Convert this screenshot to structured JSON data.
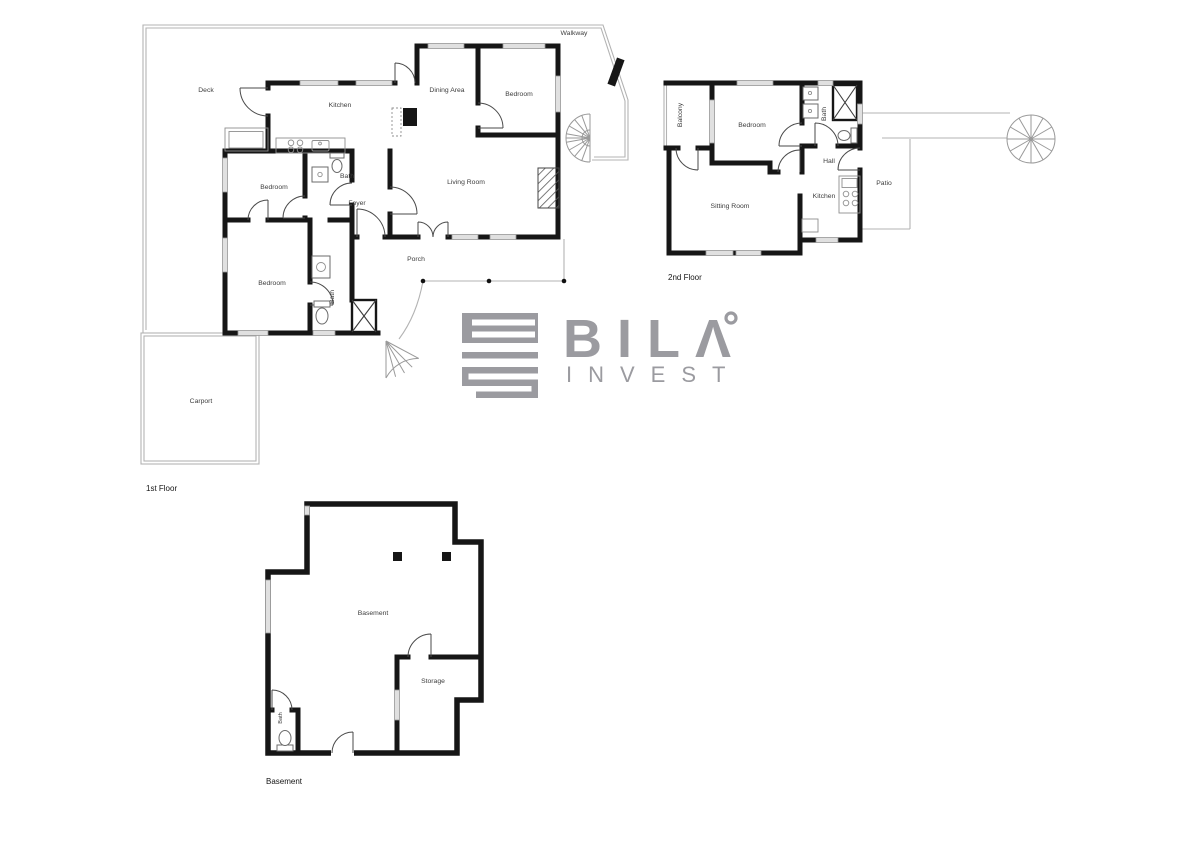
{
  "logo": {
    "title": "BILΛ",
    "subtitle": "INVEST"
  },
  "floors": {
    "first": {
      "label": "1st Floor",
      "rooms": {
        "walkway": "Walkway",
        "deck": "Deck",
        "kitchen": "Kitchen",
        "dining_area": "Dining Area",
        "bedroom_top": "Bedroom",
        "living_room": "Living Room",
        "bath_upper": "Bath",
        "foyer": "Foyer",
        "bedroom_mid": "Bedroom",
        "bedroom_lower": "Bedroom",
        "bath_lower": "Bath",
        "porch": "Porch",
        "carport": "Carport"
      }
    },
    "second": {
      "label": "2nd Floor",
      "rooms": {
        "balcony": "Balcony",
        "bedroom": "Bedroom",
        "bath": "Bath",
        "hall": "Hall",
        "patio": "Patio",
        "sitting_room": "Sitting Room",
        "kitchen": "Kitchen"
      }
    },
    "basement": {
      "label": "Basement",
      "rooms": {
        "basement": "Basement",
        "storage": "Storage",
        "bath": "Bath"
      }
    }
  },
  "colors": {
    "wall": "#161616",
    "thin_line": "#b3b3b3",
    "window_fill": "#e0e0e0",
    "label_text": "#3d3d3d",
    "logo_gray": "#9b9ba0",
    "background": "#ffffff"
  }
}
